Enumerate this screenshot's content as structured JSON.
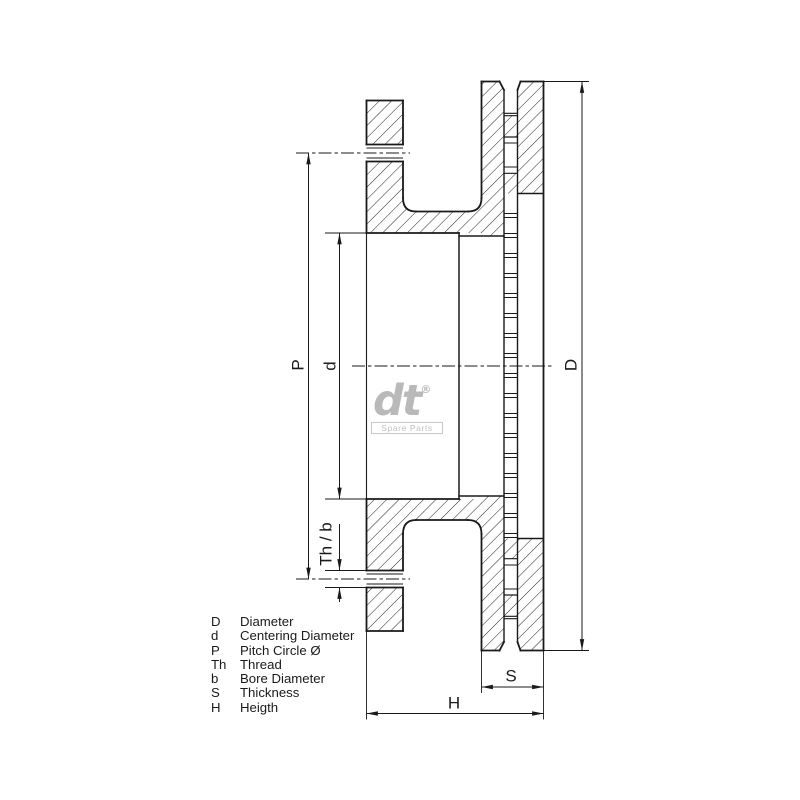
{
  "dimension_labels": {
    "pitch_circle": "P",
    "centering_diameter": "d",
    "thread_bore": "Th / b",
    "outer_diameter": "D",
    "thickness": "S",
    "height": "H"
  },
  "legend": {
    "rows": [
      {
        "abbr": "D",
        "term": "Diameter"
      },
      {
        "abbr": "d",
        "term": "Centering Diameter"
      },
      {
        "abbr": "P",
        "term": "Pitch Circle Ø"
      },
      {
        "abbr": "Th",
        "term": "Thread"
      },
      {
        "abbr": "b",
        "term": "Bore Diameter"
      },
      {
        "abbr": "S",
        "term": "Thickness"
      },
      {
        "abbr": "H",
        "term": "Heigth"
      }
    ]
  },
  "logo": {
    "brand": "dt",
    "registered": "®",
    "tagline": "Spare Parts"
  },
  "colors": {
    "line": "#1a1a1a",
    "logo_gray": "#b9b9b9"
  }
}
